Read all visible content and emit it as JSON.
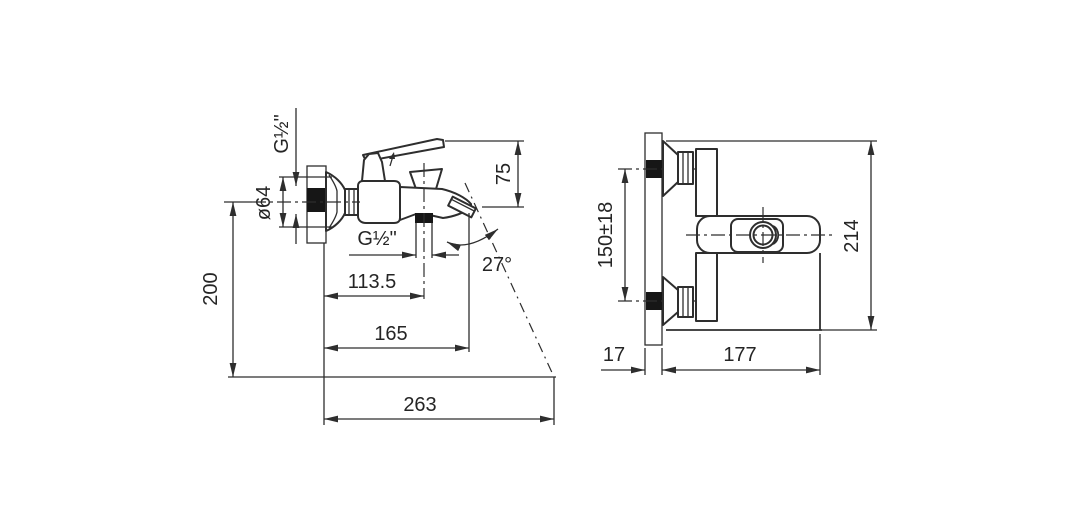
{
  "drawing": {
    "kind": "technical-dimension-drawing",
    "subject": "wall-mounted bath mixer faucet, side view and front view",
    "colors": {
      "line": "#2e2e2e",
      "text": "#252525",
      "solid_section": "#161616",
      "background": "#ffffff"
    },
    "left_view": {
      "inlet_thread": "G½\"",
      "flange_diameter": "ø64",
      "wall_height": "200",
      "spout_to_handle_top": "75",
      "shower_outlet_thread": "G½\"",
      "wall_to_outlet": "113.5",
      "spout_reach": "165",
      "max_reach": "263",
      "spout_angle": "27°"
    },
    "right_view": {
      "hole_spacing": "150±18",
      "overall_height": "214",
      "wall_offset": "17",
      "body_width": "177"
    }
  }
}
